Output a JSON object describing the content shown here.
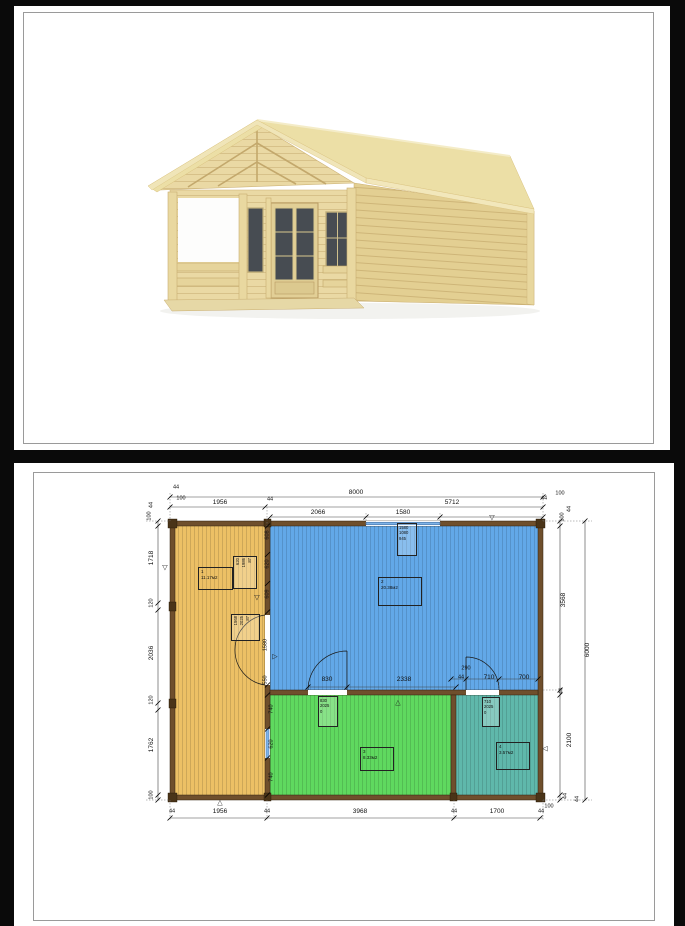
{
  "document": {
    "page_count_visible": "2",
    "page1_content": "3D render of wooden log cabin with porch",
    "page2_content": "Floor plan drawing with dimensions"
  },
  "colors": {
    "viewer-bg": "#0a0a0a",
    "paper": "#ffffff",
    "room1": "#ecc065",
    "room2": "#62a8e8",
    "room3": "#5fd95f",
    "room4": "#5fb8ab",
    "wall": "#6f4f2c",
    "wall-dark": "#4a3418",
    "window-blue": "#7eb3e8",
    "wood-light": "#ead9a4",
    "wood-mid": "#e3cf92",
    "wood-roof": "#ecdfa6",
    "glass-dark": "#474c52"
  },
  "floorplan": {
    "overall_width": "8000",
    "overall_height": "6000",
    "labels": [
      {
        "t": "8000",
        "x": 342,
        "y": 30
      },
      {
        "t": "44",
        "x": 162,
        "y": 25,
        "cls": "s"
      },
      {
        "t": "100",
        "x": 167,
        "y": 36,
        "cls": "s"
      },
      {
        "t": "1956",
        "x": 206,
        "y": 40
      },
      {
        "t": "44",
        "x": 256,
        "y": 37,
        "cls": "s"
      },
      {
        "t": "5712",
        "x": 438,
        "y": 40
      },
      {
        "t": "2066",
        "x": 304,
        "y": 50
      },
      {
        "t": "1580",
        "x": 389,
        "y": 50
      },
      {
        "t": "44",
        "x": 530,
        "y": 36,
        "cls": "s"
      },
      {
        "t": "100",
        "x": 546,
        "y": 31,
        "cls": "s"
      },
      {
        "t": "100",
        "x": 549,
        "y": 54,
        "rot": 1,
        "cls": "s"
      },
      {
        "t": "44",
        "x": 556,
        "y": 46,
        "rot": 1,
        "cls": "s"
      },
      {
        "t": "3568",
        "x": 550,
        "y": 137,
        "rot": 1
      },
      {
        "t": "44",
        "x": 548,
        "y": 228,
        "rot": 1,
        "cls": "s"
      },
      {
        "t": "2100",
        "x": 556,
        "y": 277,
        "rot": 1
      },
      {
        "t": "44",
        "x": 552,
        "y": 333,
        "rot": 1,
        "cls": "s"
      },
      {
        "t": "6000",
        "x": 574,
        "y": 187,
        "rot": 1
      },
      {
        "t": "100",
        "x": 535,
        "y": 344,
        "cls": "s"
      },
      {
        "t": "44",
        "x": 564,
        "y": 336,
        "rot": 1,
        "cls": "s"
      },
      {
        "t": "44",
        "x": 138,
        "y": 42,
        "rot": 1,
        "cls": "s"
      },
      {
        "t": "100",
        "x": 136,
        "y": 53,
        "rot": 1,
        "cls": "s"
      },
      {
        "t": "1718",
        "x": 138,
        "y": 95,
        "rot": 1
      },
      {
        "t": "120",
        "x": 138,
        "y": 140,
        "rot": 1,
        "cls": "s"
      },
      {
        "t": "2036",
        "x": 138,
        "y": 190,
        "rot": 1
      },
      {
        "t": "120",
        "x": 138,
        "y": 237,
        "rot": 1,
        "cls": "s"
      },
      {
        "t": "1762",
        "x": 138,
        "y": 282,
        "rot": 1
      },
      {
        "t": "100",
        "x": 138,
        "y": 332,
        "rot": 1,
        "cls": "s"
      },
      {
        "t": "44",
        "x": 158,
        "y": 349,
        "cls": "s"
      },
      {
        "t": "1956",
        "x": 206,
        "y": 349
      },
      {
        "t": "44",
        "x": 253,
        "y": 349,
        "cls": "s"
      },
      {
        "t": "3968",
        "x": 346,
        "y": 349
      },
      {
        "t": "44",
        "x": 440,
        "y": 349,
        "cls": "s"
      },
      {
        "t": "1700",
        "x": 483,
        "y": 349
      },
      {
        "t": "44",
        "x": 527,
        "y": 349,
        "cls": "s"
      },
      {
        "t": "830",
        "x": 313,
        "y": 217
      },
      {
        "t": "2338",
        "x": 390,
        "y": 217
      },
      {
        "t": "290",
        "x": 452,
        "y": 206,
        "cls": "s"
      },
      {
        "t": "44",
        "x": 447,
        "y": 215,
        "cls": "s"
      },
      {
        "t": "710",
        "x": 475,
        "y": 215
      },
      {
        "t": "700",
        "x": 510,
        "y": 215
      },
      {
        "t": "608",
        "x": 254,
        "y": 72,
        "rot": 1,
        "cls": "s"
      },
      {
        "t": "620",
        "x": 254,
        "y": 101,
        "rot": 1,
        "cls": "s"
      },
      {
        "t": "609",
        "x": 254,
        "y": 131,
        "rot": 1,
        "cls": "s"
      },
      {
        "t": "1580",
        "x": 252,
        "y": 182,
        "rot": 1,
        "cls": "s"
      },
      {
        "t": "550",
        "x": 252,
        "y": 217,
        "rot": 1,
        "cls": "s"
      },
      {
        "t": "740",
        "x": 258,
        "y": 246,
        "rot": 1,
        "cls": "s"
      },
      {
        "t": "620",
        "x": 258,
        "y": 281,
        "rot": 1,
        "cls": "s"
      },
      {
        "t": "740",
        "x": 258,
        "y": 314,
        "rot": 1,
        "cls": "s"
      },
      {
        "t": "▽",
        "x": 478,
        "y": 55,
        "cls": "mk"
      },
      {
        "t": "▽",
        "x": 151,
        "y": 105,
        "cls": "mk"
      },
      {
        "t": "▽",
        "x": 243,
        "y": 135,
        "cls": "mk"
      },
      {
        "t": "▷",
        "x": 261,
        "y": 194,
        "cls": "mk"
      },
      {
        "t": "△",
        "x": 384,
        "y": 240,
        "cls": "mk"
      },
      {
        "t": "◁",
        "x": 531,
        "y": 286,
        "cls": "mk"
      },
      {
        "t": "△",
        "x": 206,
        "y": 340,
        "cls": "mk"
      }
    ],
    "rooms": [
      {
        "num": "1",
        "area": "11.17м2",
        "x": 184,
        "y": 104,
        "w": 33,
        "h": 21
      },
      {
        "num": "2",
        "area": "20.38м2",
        "x": 364,
        "y": 114,
        "w": 42,
        "h": 27
      },
      {
        "num": "3",
        "area": "8.33м2",
        "x": 346,
        "y": 284,
        "w": 32,
        "h": 22
      },
      {
        "num": "4",
        "area": "3.57м2",
        "x": 482,
        "y": 279,
        "w": 32,
        "h": 26
      }
    ],
    "spec_boxes": [
      {
        "lines": [
          "620",
          "1986",
          "87"
        ],
        "x": 219,
        "y": 93,
        "w": 22,
        "h": 30,
        "rot": true
      },
      {
        "lines": [
          "1568",
          "2025",
          "87"
        ],
        "x": 217,
        "y": 151,
        "w": 27,
        "h": 24,
        "rot": true
      },
      {
        "lines": [
          "830",
          "2025",
          "0"
        ],
        "x": 304,
        "y": 233,
        "w": 17,
        "h": 28,
        "rot": false
      },
      {
        "lines": [
          "710",
          "2025",
          "0"
        ],
        "x": 468,
        "y": 234,
        "w": 15,
        "h": 27,
        "rot": false
      },
      {
        "lines": [
          "1580",
          "1080",
          "945"
        ],
        "x": 383,
        "y": 60,
        "w": 17,
        "h": 30,
        "rot": false
      }
    ]
  }
}
